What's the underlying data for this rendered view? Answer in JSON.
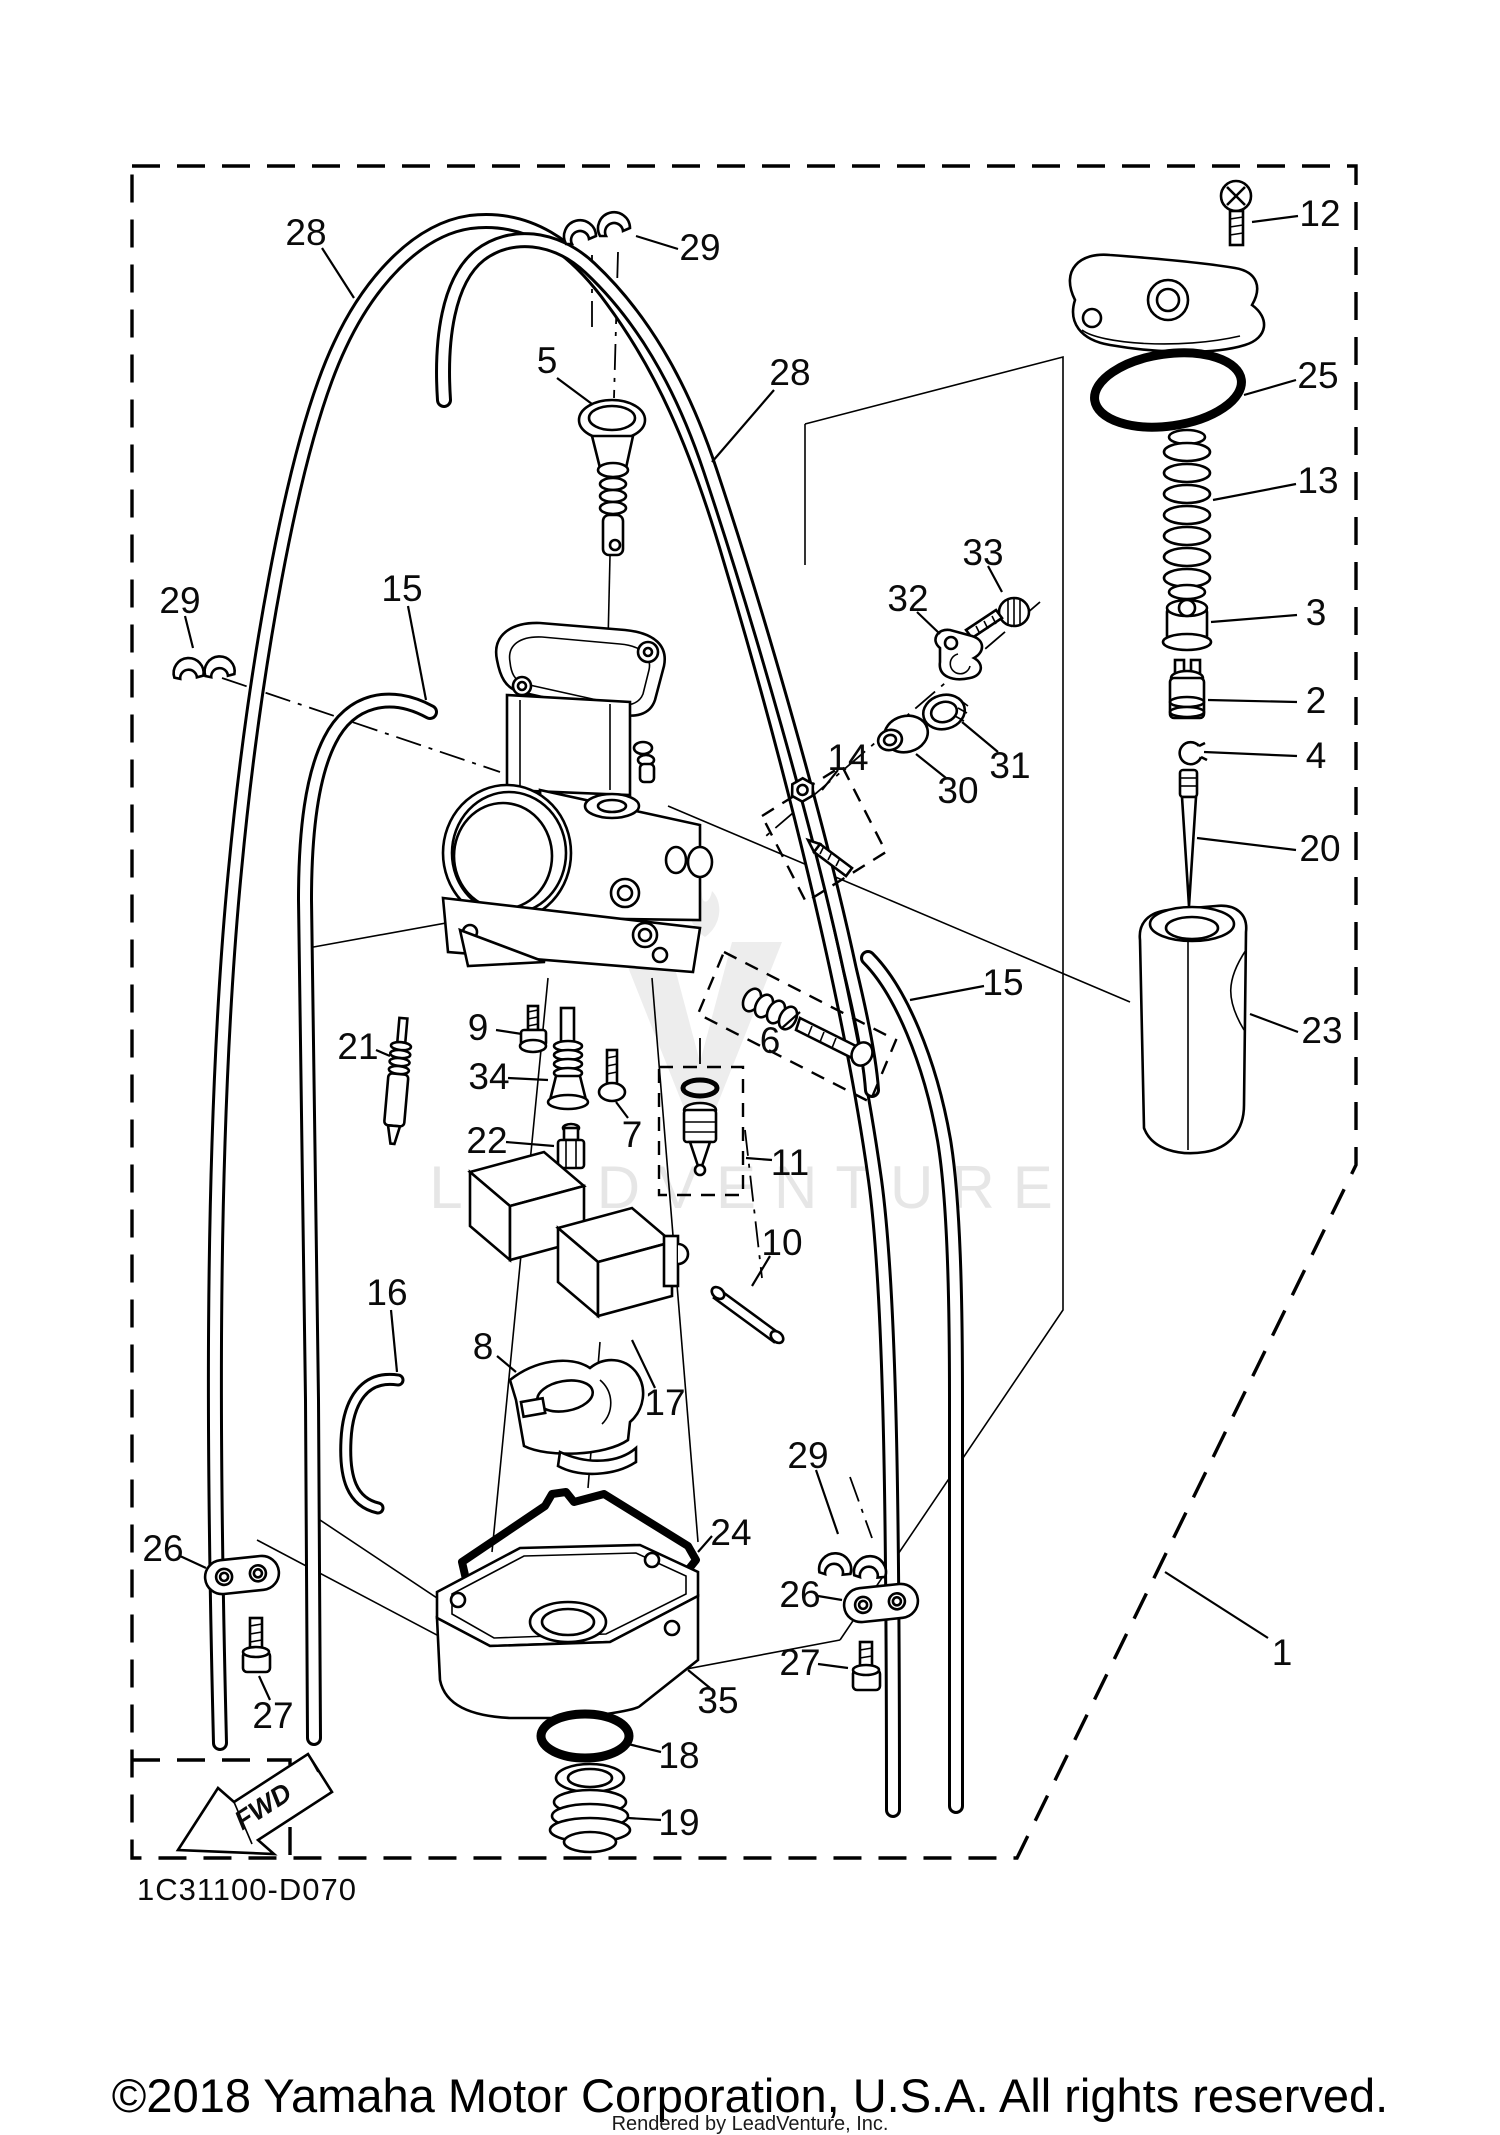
{
  "diagram": {
    "code": "1C31100-D070",
    "fwd_label": "FWD"
  },
  "watermark": {
    "text": "LEADVENTURE"
  },
  "footer": {
    "copyright": "©2018 Yamaha Motor Corporation, U.S.A. All rights reserved.",
    "rendered_by": "Rendered by LeadVenture, Inc."
  },
  "callouts": [
    {
      "label": "28",
      "x": 306,
      "y": 232,
      "leader": [
        322,
        248,
        354,
        298
      ]
    },
    {
      "label": "29",
      "x": 700,
      "y": 247,
      "leader": [
        678,
        249,
        636,
        236
      ]
    },
    {
      "label": "28",
      "x": 790,
      "y": 372,
      "leader": [
        774,
        390,
        712,
        462
      ]
    },
    {
      "label": "5",
      "x": 547,
      "y": 360,
      "leader": [
        557,
        378,
        592,
        404
      ]
    },
    {
      "label": "12",
      "x": 1320,
      "y": 213,
      "leader": [
        1298,
        216,
        1252,
        222
      ]
    },
    {
      "label": "25",
      "x": 1318,
      "y": 375,
      "leader": [
        1296,
        380,
        1244,
        395
      ]
    },
    {
      "label": "13",
      "x": 1318,
      "y": 480,
      "leader": [
        1296,
        484,
        1213,
        500
      ]
    },
    {
      "label": "3",
      "x": 1316,
      "y": 612,
      "leader": [
        1297,
        615,
        1211,
        622
      ]
    },
    {
      "label": "2",
      "x": 1316,
      "y": 700,
      "leader": [
        1297,
        702,
        1208,
        700
      ]
    },
    {
      "label": "4",
      "x": 1316,
      "y": 755,
      "leader": [
        1297,
        756,
        1204,
        752
      ]
    },
    {
      "label": "20",
      "x": 1320,
      "y": 848,
      "leader": [
        1296,
        850,
        1197,
        838
      ]
    },
    {
      "label": "23",
      "x": 1322,
      "y": 1030,
      "leader": [
        1298,
        1032,
        1250,
        1014
      ]
    },
    {
      "label": "33",
      "x": 983,
      "y": 552,
      "leader": [
        988,
        566,
        1002,
        592
      ]
    },
    {
      "label": "32",
      "x": 908,
      "y": 598,
      "leader": [
        917,
        612,
        940,
        634
      ]
    },
    {
      "label": "31",
      "x": 1010,
      "y": 765,
      "leader": [
        998,
        752,
        962,
        722
      ]
    },
    {
      "label": "30",
      "x": 958,
      "y": 790,
      "leader": [
        946,
        778,
        916,
        754
      ]
    },
    {
      "label": "14",
      "x": 848,
      "y": 757,
      "leader": [
        838,
        770,
        822,
        790
      ]
    },
    {
      "label": "15",
      "x": 402,
      "y": 588,
      "leader": [
        408,
        606,
        426,
        700
      ]
    },
    {
      "label": "29",
      "x": 180,
      "y": 600,
      "leader": [
        185,
        616,
        193,
        648
      ]
    },
    {
      "label": "15",
      "x": 1003,
      "y": 982,
      "leader": [
        984,
        986,
        910,
        1000
      ]
    },
    {
      "label": "21",
      "x": 358,
      "y": 1046,
      "leader": [
        376,
        1050,
        390,
        1056
      ]
    },
    {
      "label": "9",
      "x": 478,
      "y": 1027,
      "leader": [
        496,
        1030,
        522,
        1034
      ]
    },
    {
      "label": "34",
      "x": 489,
      "y": 1076,
      "leader": [
        508,
        1078,
        548,
        1080
      ]
    },
    {
      "label": "22",
      "x": 487,
      "y": 1140,
      "leader": [
        506,
        1142,
        554,
        1146
      ]
    },
    {
      "label": "7",
      "x": 632,
      "y": 1134,
      "leader": [
        628,
        1118,
        616,
        1102
      ]
    },
    {
      "label": "6",
      "x": 770,
      "y": 1040,
      "leader": [
        782,
        1028,
        800,
        1012
      ]
    },
    {
      "label": "11",
      "x": 790,
      "y": 1162,
      "leader": [
        772,
        1160,
        746,
        1158
      ]
    },
    {
      "label": "10",
      "x": 782,
      "y": 1242,
      "leader": [
        770,
        1256,
        752,
        1286
      ]
    },
    {
      "label": "16",
      "x": 387,
      "y": 1292,
      "leader": [
        391,
        1310,
        397,
        1372
      ]
    },
    {
      "label": "8",
      "x": 483,
      "y": 1346,
      "leader": [
        497,
        1356,
        516,
        1372
      ]
    },
    {
      "label": "17",
      "x": 665,
      "y": 1402,
      "leader": [
        655,
        1388,
        632,
        1340
      ]
    },
    {
      "label": "24",
      "x": 731,
      "y": 1532,
      "leader": [
        712,
        1536,
        698,
        1552
      ]
    },
    {
      "label": "29",
      "x": 808,
      "y": 1455,
      "leader": [
        816,
        1470,
        838,
        1534
      ]
    },
    {
      "label": "26",
      "x": 163,
      "y": 1548,
      "leader": [
        180,
        1556,
        206,
        1568
      ]
    },
    {
      "label": "27",
      "x": 273,
      "y": 1715,
      "leader": [
        270,
        1700,
        259,
        1676
      ]
    },
    {
      "label": "26",
      "x": 800,
      "y": 1594,
      "leader": [
        818,
        1596,
        842,
        1600
      ]
    },
    {
      "label": "27",
      "x": 800,
      "y": 1662,
      "leader": [
        818,
        1664,
        848,
        1668
      ]
    },
    {
      "label": "35",
      "x": 718,
      "y": 1700,
      "leader": [
        710,
        1688,
        688,
        1670
      ]
    },
    {
      "label": "18",
      "x": 679,
      "y": 1755,
      "leader": [
        661,
        1752,
        628,
        1744
      ]
    },
    {
      "label": "19",
      "x": 679,
      "y": 1822,
      "leader": [
        661,
        1820,
        628,
        1818
      ]
    },
    {
      "label": "1",
      "x": 1282,
      "y": 1652,
      "leader": [
        1268,
        1638,
        1165,
        1572
      ]
    }
  ]
}
